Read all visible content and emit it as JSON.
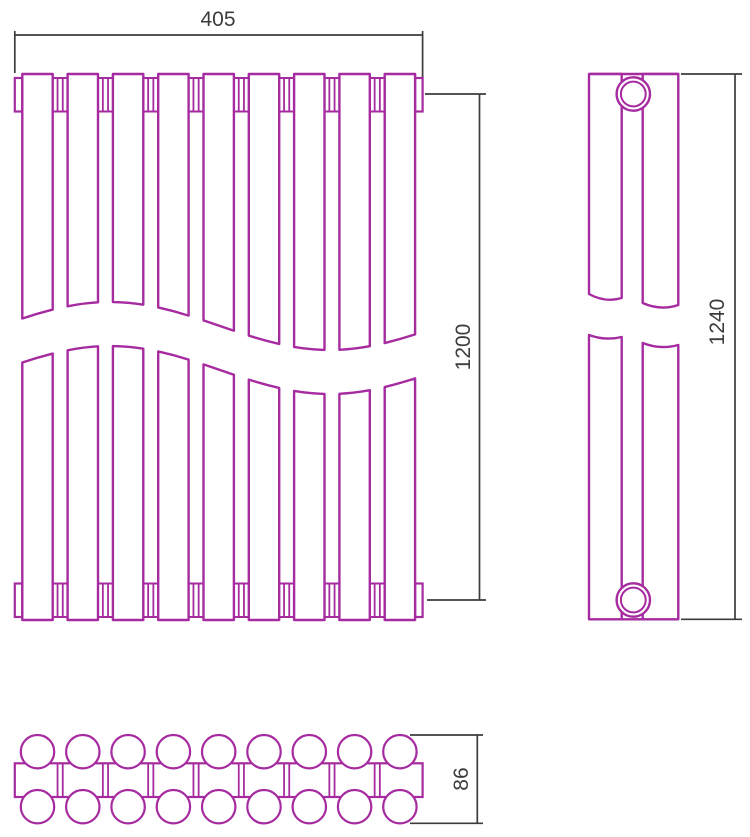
{
  "title": "Radiator technical drawing - orthographic projections",
  "colors": {
    "line": "#a62ba0",
    "dimension": "#3c3c3e",
    "background": "#ffffff"
  },
  "drawing": {
    "sections": 9,
    "views": [
      {
        "id": "front",
        "label": "front view with break lines"
      },
      {
        "id": "side",
        "label": "side view with pipe fittings"
      },
      {
        "id": "plan",
        "label": "top view of tube pairs and collector"
      }
    ],
    "dimensions": {
      "width": {
        "label": "405"
      },
      "axis_height": {
        "label": "1200"
      },
      "overall_height": {
        "label": "1240"
      },
      "depth": {
        "label": "86"
      }
    }
  }
}
